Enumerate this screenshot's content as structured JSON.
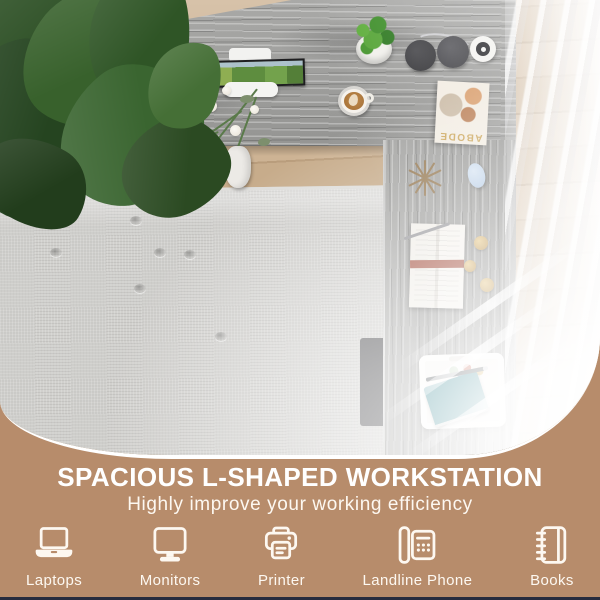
{
  "colors": {
    "banner_bg": "#b78c6b",
    "banner_text": "#fdf8f1",
    "bottom_line": "#272c3e",
    "desk_wood_gray": "#a1a19f",
    "floor_wood": "#c8ad8d",
    "rug_gray": "#d1d0cd",
    "notebook_teal": "#15727f",
    "magazine_gold": "#c9a253",
    "photo_rim": "#ffffff"
  },
  "banner": {
    "title": "SPACIOUS L-SHAPED WORKSTATION",
    "subtitle": "Highly improve your working efficiency",
    "features": [
      {
        "icon": "laptop-icon",
        "label": "Laptops"
      },
      {
        "icon": "monitor-icon",
        "label": "Monitors"
      },
      {
        "icon": "printer-icon",
        "label": "Printer"
      },
      {
        "icon": "landline-phone-icon",
        "label": "Landline Phone"
      },
      {
        "icon": "books-icon",
        "label": "Books"
      }
    ]
  },
  "photo": {
    "magazine_title": "ABODE"
  }
}
